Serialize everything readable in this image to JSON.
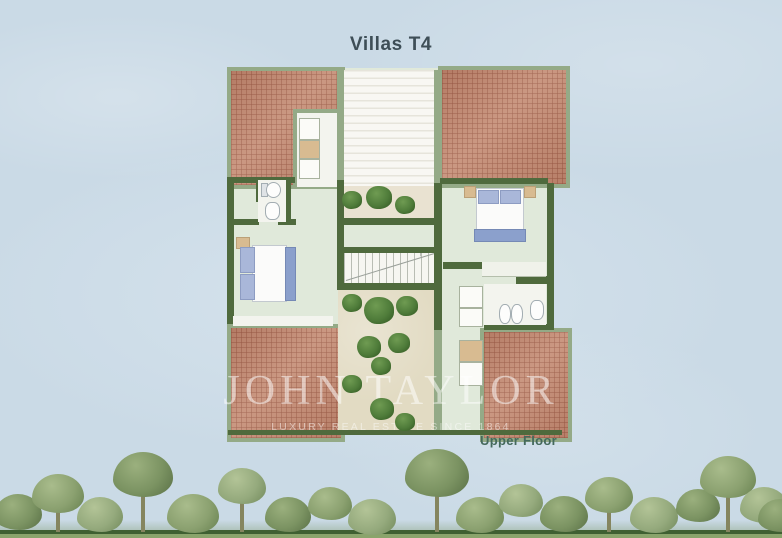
{
  "title": "Villas T4",
  "floor_label": "Upper Floor",
  "watermark": {
    "brand": "JOHN TAYLOR",
    "tagline": "LUXURY REAL ESTATE SINCE 1864"
  },
  "colors": {
    "sky": "#cadae6",
    "floor": "#e0e9da",
    "wall": "#4f6a3d",
    "band": "#94aa87",
    "roof": "#c28a73",
    "court": "#e2dbc3",
    "terrace": "#e9e2d1",
    "tan": "#d8bb91",
    "pillow": "#a9b7d9",
    "bench": "#8ba0cc",
    "title": "#3e4e57",
    "label": "#44695c",
    "watermark": "rgba(255,255,255,0.52)"
  },
  "plan": {
    "bushes_terrace": [
      [
        352,
        200,
        10
      ],
      [
        379,
        198,
        13
      ],
      [
        405,
        205,
        10
      ]
    ],
    "bushes_courtyard": [
      [
        352,
        303,
        10
      ],
      [
        379,
        311,
        15
      ],
      [
        407,
        306,
        11
      ],
      [
        369,
        347,
        12
      ],
      [
        399,
        343,
        11
      ],
      [
        381,
        366,
        10
      ],
      [
        352,
        384,
        10
      ],
      [
        382,
        409,
        12
      ],
      [
        405,
        422,
        10
      ]
    ]
  },
  "scenery": {
    "palette": [
      {
        "base": "#8ba170",
        "light": "#a9bc8c",
        "dark": "#66804f"
      },
      {
        "base": "#7b9362",
        "light": "#9bb07e",
        "dark": "#586f45"
      },
      {
        "base": "#95aa7d",
        "light": "#b3c497",
        "dark": "#71895b"
      }
    ],
    "trees": [
      [
        18,
        494,
        24,
        1,
        0
      ],
      [
        58,
        474,
        26,
        0,
        1
      ],
      [
        100,
        497,
        23,
        2,
        0
      ],
      [
        143,
        452,
        30,
        1,
        1
      ],
      [
        193,
        494,
        26,
        0,
        0
      ],
      [
        242,
        468,
        24,
        2,
        1
      ],
      [
        288,
        497,
        23,
        1,
        0
      ],
      [
        330,
        487,
        22,
        0,
        0
      ],
      [
        372,
        499,
        24,
        2,
        0
      ],
      [
        437,
        449,
        32,
        1,
        1
      ],
      [
        480,
        497,
        24,
        0,
        0
      ],
      [
        521,
        484,
        22,
        2,
        0
      ],
      [
        564,
        496,
        24,
        1,
        0
      ],
      [
        609,
        477,
        24,
        0,
        1
      ],
      [
        654,
        497,
        24,
        2,
        0
      ],
      [
        698,
        489,
        22,
        1,
        0
      ],
      [
        728,
        456,
        28,
        0,
        1
      ],
      [
        764,
        487,
        24,
        2,
        0
      ],
      [
        780,
        499,
        22,
        1,
        0
      ]
    ]
  }
}
